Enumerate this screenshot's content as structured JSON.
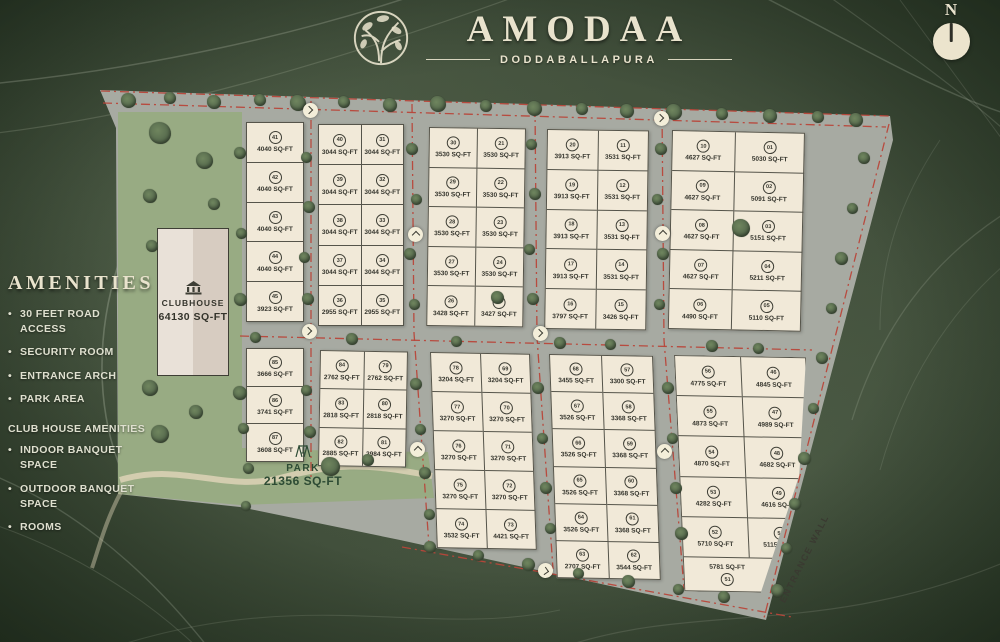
{
  "header": {
    "title": "AMODAA",
    "subtitle": "DODDABALLAPURA",
    "compass_label": "N"
  },
  "amenities": {
    "heading": "AMENITIES",
    "items": [
      "30 FEET ROAD ACCESS",
      "SECURITY ROOM",
      "ENTRANCE ARCH",
      "PARK AREA"
    ],
    "club_heading": "CLUB HOUSE AMENITIES",
    "club_items": [
      "INDOOR BANQUET SPACE",
      "OUTDOOR BANQUET SPACE",
      "ROOMS"
    ]
  },
  "landmarks": {
    "clubhouse": {
      "label": "CLUBHOUSE",
      "area": "64130 SQ-FT"
    },
    "park": {
      "label": "PARK",
      "area": "21356 SQ-FT"
    },
    "entrance_wall_label": "ENTRANCE WALL"
  },
  "blocks": [
    {
      "id": "a",
      "columns": [
        [
          {
            "no": "41",
            "area": "4040 SQ-FT"
          },
          {
            "no": "42",
            "area": "4040 SQ-FT"
          },
          {
            "no": "43",
            "area": "4040 SQ-FT"
          },
          {
            "no": "44",
            "area": "4040 SQ-FT"
          },
          {
            "no": "45",
            "area": "3923 SQ-FT"
          }
        ]
      ]
    },
    {
      "id": "b",
      "columns": [
        [
          {
            "no": "40",
            "area": "3044 SQ-FT"
          },
          {
            "no": "39",
            "area": "3044 SQ-FT"
          },
          {
            "no": "38",
            "area": "3044 SQ-FT"
          },
          {
            "no": "37",
            "area": "3044 SQ-FT"
          },
          {
            "no": "36",
            "area": "2955 SQ-FT"
          }
        ],
        [
          {
            "no": "31",
            "area": "3044 SQ-FT"
          },
          {
            "no": "32",
            "area": "3044 SQ-FT"
          },
          {
            "no": "33",
            "area": "3044 SQ-FT"
          },
          {
            "no": "34",
            "area": "3044 SQ-FT"
          },
          {
            "no": "35",
            "area": "2955 SQ-FT"
          }
        ]
      ]
    },
    {
      "id": "c",
      "columns": [
        [
          {
            "no": "30",
            "area": "3530 SQ-FT"
          },
          {
            "no": "29",
            "area": "3530 SQ-FT"
          },
          {
            "no": "28",
            "area": "3530 SQ-FT"
          },
          {
            "no": "27",
            "area": "3530 SQ-FT"
          },
          {
            "no": "26",
            "area": "3428 SQ-FT"
          }
        ],
        [
          {
            "no": "21",
            "area": "3530 SQ-FT"
          },
          {
            "no": "22",
            "area": "3530 SQ-FT"
          },
          {
            "no": "23",
            "area": "3530 SQ-FT"
          },
          {
            "no": "24",
            "area": "3530 SQ-FT"
          },
          {
            "no": "25",
            "area": "3427 SQ-FT"
          }
        ]
      ]
    },
    {
      "id": "d",
      "columns": [
        [
          {
            "no": "20",
            "area": "3913 SQ-FT"
          },
          {
            "no": "19",
            "area": "3913 SQ-FT"
          },
          {
            "no": "18",
            "area": "3913 SQ-FT"
          },
          {
            "no": "17",
            "area": "3913 SQ-FT"
          },
          {
            "no": "16",
            "area": "3797 SQ-FT"
          }
        ],
        [
          {
            "no": "11",
            "area": "3531 SQ-FT"
          },
          {
            "no": "12",
            "area": "3531 SQ-FT"
          },
          {
            "no": "13",
            "area": "3531 SQ-FT"
          },
          {
            "no": "14",
            "area": "3531 SQ-FT"
          },
          {
            "no": "15",
            "area": "3426 SQ-FT"
          }
        ]
      ]
    },
    {
      "id": "e",
      "columns": [
        [
          {
            "no": "10",
            "area": "4627 SQ-FT"
          },
          {
            "no": "09",
            "area": "4627 SQ-FT"
          },
          {
            "no": "08",
            "area": "4627 SQ-FT"
          },
          {
            "no": "07",
            "area": "4627 SQ-FT"
          },
          {
            "no": "06",
            "area": "4490 SQ-FT"
          }
        ],
        [
          {
            "no": "01",
            "area": "5030 SQ-FT"
          },
          {
            "no": "02",
            "area": "5091 SQ-FT"
          },
          {
            "no": "03",
            "area": "5151 SQ-FT"
          },
          {
            "no": "04",
            "area": "5211 SQ-FT"
          },
          {
            "no": "05",
            "area": "5110 SQ-FT"
          }
        ]
      ]
    },
    {
      "id": "f",
      "columns": [
        [
          {
            "no": "85",
            "area": "3666 SQ-FT"
          },
          {
            "no": "86",
            "area": "3741 SQ-FT"
          },
          {
            "no": "87",
            "area": "3608 SQ-FT"
          }
        ]
      ]
    },
    {
      "id": "g",
      "columns": [
        [
          {
            "no": "84",
            "area": "2762 SQ-FT"
          },
          {
            "no": "83",
            "area": "2818 SQ-FT"
          },
          {
            "no": "82",
            "area": "2885 SQ-FT"
          }
        ],
        [
          {
            "no": "79",
            "area": "2762 SQ-FT"
          },
          {
            "no": "80",
            "area": "2818 SQ-FT"
          },
          {
            "no": "81",
            "area": "2984 SQ-FT"
          }
        ]
      ]
    },
    {
      "id": "h",
      "columns": [
        [
          {
            "no": "78",
            "area": "3204 SQ-FT"
          },
          {
            "no": "77",
            "area": "3270 SQ-FT"
          },
          {
            "no": "76",
            "area": "3270 SQ-FT"
          },
          {
            "no": "75",
            "area": "3270 SQ-FT"
          },
          {
            "no": "74",
            "area": "3532 SQ-FT"
          }
        ],
        [
          {
            "no": "69",
            "area": "3204 SQ-FT"
          },
          {
            "no": "70",
            "area": "3270 SQ-FT"
          },
          {
            "no": "71",
            "area": "3270 SQ-FT"
          },
          {
            "no": "72",
            "area": "3270 SQ-FT"
          },
          {
            "no": "73",
            "area": "4421 SQ-FT"
          }
        ]
      ]
    },
    {
      "id": "i",
      "columns": [
        [
          {
            "no": "68",
            "area": "3455 SQ-FT"
          },
          {
            "no": "67",
            "area": "3526 SQ-FT"
          },
          {
            "no": "66",
            "area": "3526 SQ-FT"
          },
          {
            "no": "65",
            "area": "3526 SQ-FT"
          },
          {
            "no": "64",
            "area": "3526 SQ-FT"
          },
          {
            "no": "63",
            "area": "2707 SQ-FT"
          }
        ],
        [
          {
            "no": "57",
            "area": "3300 SQ-FT"
          },
          {
            "no": "58",
            "area": "3368 SQ-FT"
          },
          {
            "no": "59",
            "area": "3368 SQ-FT"
          },
          {
            "no": "60",
            "area": "3368 SQ-FT"
          },
          {
            "no": "61",
            "area": "3368 SQ-FT"
          },
          {
            "no": "62",
            "area": "3544 SQ-FT"
          }
        ]
      ]
    },
    {
      "id": "j",
      "columns": [
        [
          {
            "no": "56",
            "area": "4775 SQ-FT"
          },
          {
            "no": "55",
            "area": "4873 SQ-FT"
          },
          {
            "no": "54",
            "area": "4870 SQ-FT"
          },
          {
            "no": "53",
            "area": "4282 SQ-FT"
          },
          {
            "no": "52",
            "area": "5710 SQ-FT"
          }
        ],
        [
          {
            "no": "46",
            "area": "4845 SQ-FT"
          },
          {
            "no": "47",
            "area": "4989 SQ-FT"
          },
          {
            "no": "48",
            "area": "4682 SQ-FT"
          },
          {
            "no": "49",
            "area": "4616 SQ-FT"
          },
          {
            "no": "50",
            "area": "5115 SQ-FT"
          }
        ]
      ],
      "footer": {
        "no": "51",
        "area": "5781 SQ-FT"
      }
    }
  ],
  "palette": {
    "road": "#a7aaa2",
    "plot": "#f1e9d8",
    "plotBorder": "#55544a",
    "park": "#98ab83",
    "red": "#b8463a",
    "cream": "#e9e3cd",
    "ink": "#34342c",
    "clubL": "#e9e1d8",
    "clubR": "#d7ccc1",
    "parkText": "#2d4b34"
  }
}
